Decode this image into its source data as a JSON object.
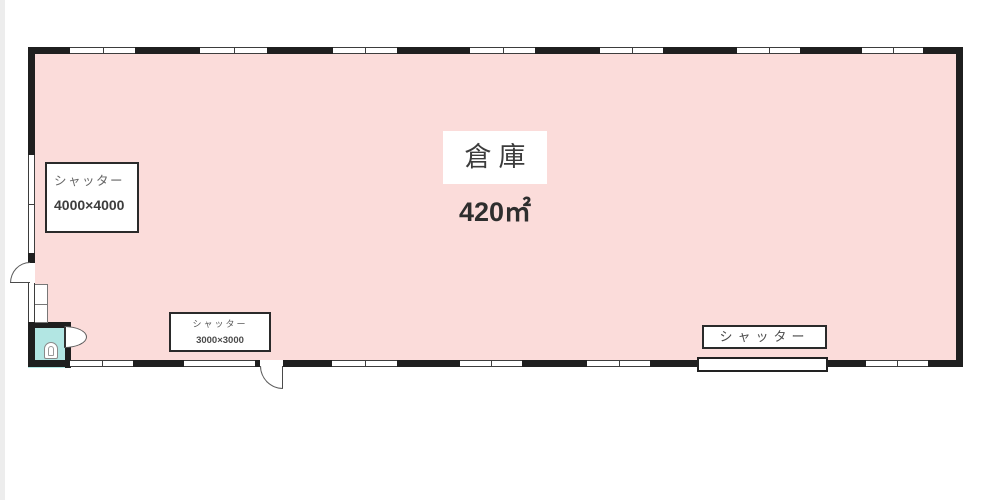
{
  "plan": {
    "room_label": "倉庫",
    "area_label": "420㎡",
    "shutter_left": {
      "name": "シャッター",
      "size": "4000×4000"
    },
    "shutter_bottom": {
      "name": "シャッター",
      "size": "3000×3000"
    },
    "shutter_right": {
      "name": "シャッター"
    }
  },
  "colors": {
    "floor": "#fbdcda",
    "toilet": "#b2e6e3",
    "wall": "#1f1f1f"
  }
}
